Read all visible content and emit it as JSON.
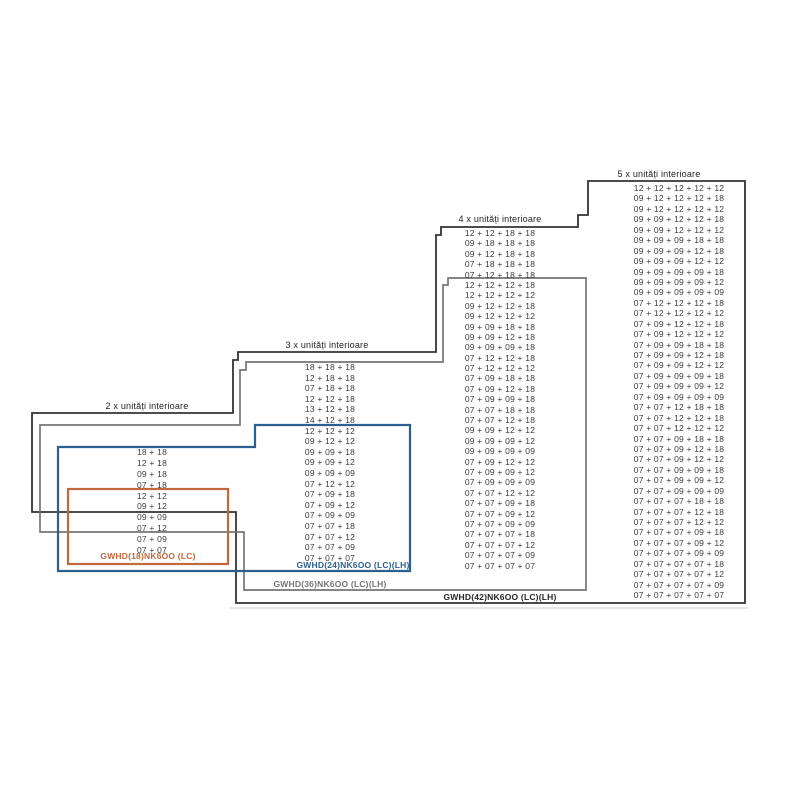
{
  "columns": [
    {
      "id": "2x",
      "header": "2 x unități interioare",
      "rows": [
        "18 + 18",
        "12 + 18",
        "09 + 18",
        "07 + 18",
        "12 + 12",
        "09 + 12",
        "09 + 09",
        "07 + 12",
        "07 + 09",
        "07 + 07"
      ]
    },
    {
      "id": "3x",
      "header": "3 x unități interioare",
      "rows": [
        "18 + 18 + 18",
        "12 + 18 + 18",
        "07 + 18 + 18",
        "12 + 12 + 18",
        "13 + 12 + 18",
        "14 + 12 + 18",
        "12 + 12 + 12",
        "09 + 12 + 12",
        "09 + 09 + 18",
        "09 + 09 + 12",
        "09 + 09 + 09",
        "07 + 12 + 12",
        "07 + 09 + 18",
        "07 + 09 + 12",
        "07 + 09 + 09",
        "07 + 07 + 18",
        "07 + 07 + 12",
        "07 + 07 + 09",
        "07 + 07 + 07"
      ]
    },
    {
      "id": "4x",
      "header": "4 x unități interioare",
      "rows": [
        "12 + 12 + 18 + 18",
        "09 + 18 + 18 + 18",
        "09 + 12 + 18 + 18",
        "07 + 18 + 18 + 18",
        "07 + 12 + 18 + 18",
        "12 + 12 + 12 + 18",
        "12 + 12 + 12 + 12",
        "09 + 12 + 12 + 18",
        "09 + 12 + 12 + 12",
        "09 + 09 + 18 + 18",
        "09 + 09 + 12 + 18",
        "09 + 09 + 09 + 18",
        "07 + 12 + 12 + 18",
        "07 + 12 + 12 + 12",
        "07 + 09 + 18 + 18",
        "07 + 09 + 12 + 18",
        "07 + 09 + 09 + 18",
        "07 + 07 + 18 + 18",
        "07 + 07 + 12 + 18",
        "09 + 09 + 12 + 12",
        "09 + 09 + 09 + 12",
        "09 + 09 + 09 + 09",
        "07 + 09 + 12 + 12",
        "07 + 09 + 09 + 12",
        "07 + 09 + 09 + 09",
        "07 + 07 + 12 + 12",
        "07 + 07 + 09 + 18",
        "07 + 07 + 09 + 12",
        "07 + 07 + 09 + 09",
        "07 + 07 + 07 + 18",
        "07 + 07 + 07 + 12",
        "07 + 07 + 07 + 09",
        "07 + 07 + 07 + 07"
      ]
    },
    {
      "id": "5x",
      "header": "5 x unități interioare",
      "rows": [
        "12 + 12 + 12 + 12 + 12",
        "09 + 12 + 12 + 12 + 18",
        "09 + 12 + 12 + 12 + 12",
        "09 + 09 + 12 + 12 + 18",
        "09 + 09 + 12 + 12 + 12",
        "09 + 09 + 09 + 18 + 18",
        "09 + 09 + 09 + 12 + 18",
        "09 + 09 + 09 + 12 + 12",
        "09 + 09 + 09 + 09 + 18",
        "09 + 09 + 09 + 09 + 12",
        "09 + 09 + 09 + 09 + 09",
        "07 + 12 + 12 + 12 + 18",
        "07 + 12 + 12 + 12 + 12",
        "07 + 09 + 12 + 12 + 18",
        "07 + 09 + 12 + 12 + 12",
        "07 + 09 + 09 + 18 + 18",
        "07 + 09 + 09 + 12 + 18",
        "07 + 09 + 09 + 12 + 12",
        "07 + 09 + 09 + 09 + 18",
        "07 + 09 + 09 + 09 + 12",
        "07 + 09 + 09 + 09 + 09",
        "07 + 07 + 12 + 18 + 18",
        "07 + 07 + 12 + 12 + 18",
        "07 + 07 + 12 + 12 + 12",
        "07 + 07 + 09 + 18 + 18",
        "07 + 07 + 09 + 12 + 18",
        "07 + 07 + 09 + 12 + 12",
        "07 + 07 + 09 + 09 + 18",
        "07 + 07 + 09 + 09 + 12",
        "07 + 07 + 09 + 09 + 09",
        "07 + 07 + 07 + 18 + 18",
        "07 + 07 + 07 + 12 + 18",
        "07 + 07 + 07 + 12 + 12",
        "07 + 07 + 07 + 09 + 18",
        "07 + 07 + 07 + 09 + 12",
        "07 + 07 + 07 + 09 + 09",
        "07 + 07 + 07 + 07 + 18",
        "07 + 07 + 07 + 07 + 12",
        "07 + 07 + 07 + 07 + 09",
        "07 + 07 + 07 + 07 + 07"
      ]
    }
  ],
  "boxes": [
    {
      "id": "gwhd18",
      "label": "GWHD(18)NK6OO (LC)",
      "color": "#c2683a"
    },
    {
      "id": "gwhd24",
      "label": "GWHD(24)NK6OO (LC)(LH)",
      "color": "#2b5f8e"
    },
    {
      "id": "gwhd36",
      "label": "GWHD(36)NK6OO (LC)(LH)",
      "color": "#757575"
    },
    {
      "id": "gwhd42",
      "label": "GWHD(42)NK6OO (LC)(LH)",
      "color": "#333333"
    }
  ]
}
